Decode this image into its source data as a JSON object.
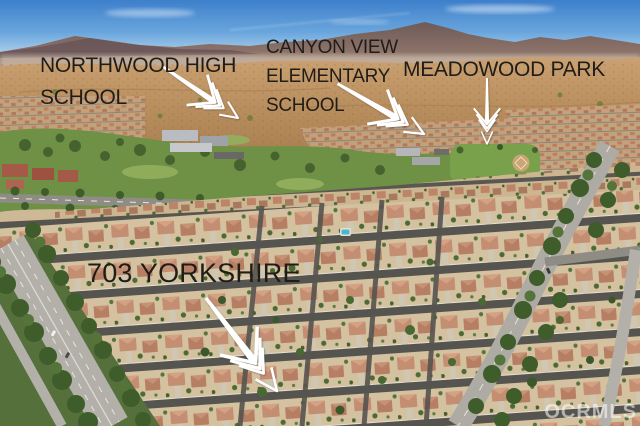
{
  "scene": {
    "type": "aerial-photograph",
    "description": "Aerial drone view of a suburban residential neighborhood with tree-lined arterial roads, schools, a park, foothills and mountains under a blue sky"
  },
  "annotations": [
    {
      "id": "northwood-high-school",
      "lines": [
        "NORTHWOOD HIGH",
        "SCHOOL"
      ],
      "arrow": "white arrow pointing down-right to the high-school campus"
    },
    {
      "id": "canyon-view-elementary-school",
      "lines": [
        "CANYON VIEW",
        "ELEMENTARY",
        "SCHOOL"
      ],
      "arrow": "white arrow pointing down-right to the elementary-school campus"
    },
    {
      "id": "meadowood-park",
      "lines": [
        "MEADOWOOD PARK"
      ],
      "arrow": "white arrow pointing straight down to the park"
    },
    {
      "id": "703-yorkshire",
      "lines": [
        "703 YORKSHIRE"
      ],
      "arrow": "white arrow pointing down-right to the property"
    }
  ],
  "watermark": {
    "text": "OCRMLS"
  },
  "colors": {
    "label_text": "#201c18",
    "arrow": "#ffffff",
    "watermark": "rgba(255,255,255,0.55)",
    "sky_top": "#3d7fcb",
    "sky_horizon": "#e2eef7",
    "mountains": "#6f5a58",
    "foothills": "#b98e5e",
    "greenbelt": "#6f9146",
    "trees": "#44602f",
    "house_roof": "#c48e72",
    "lot_ground": "#d3c1a0",
    "residential_street": "#56544f",
    "arterial_road": "#b3b0a9",
    "pool": "#45b8d6"
  }
}
